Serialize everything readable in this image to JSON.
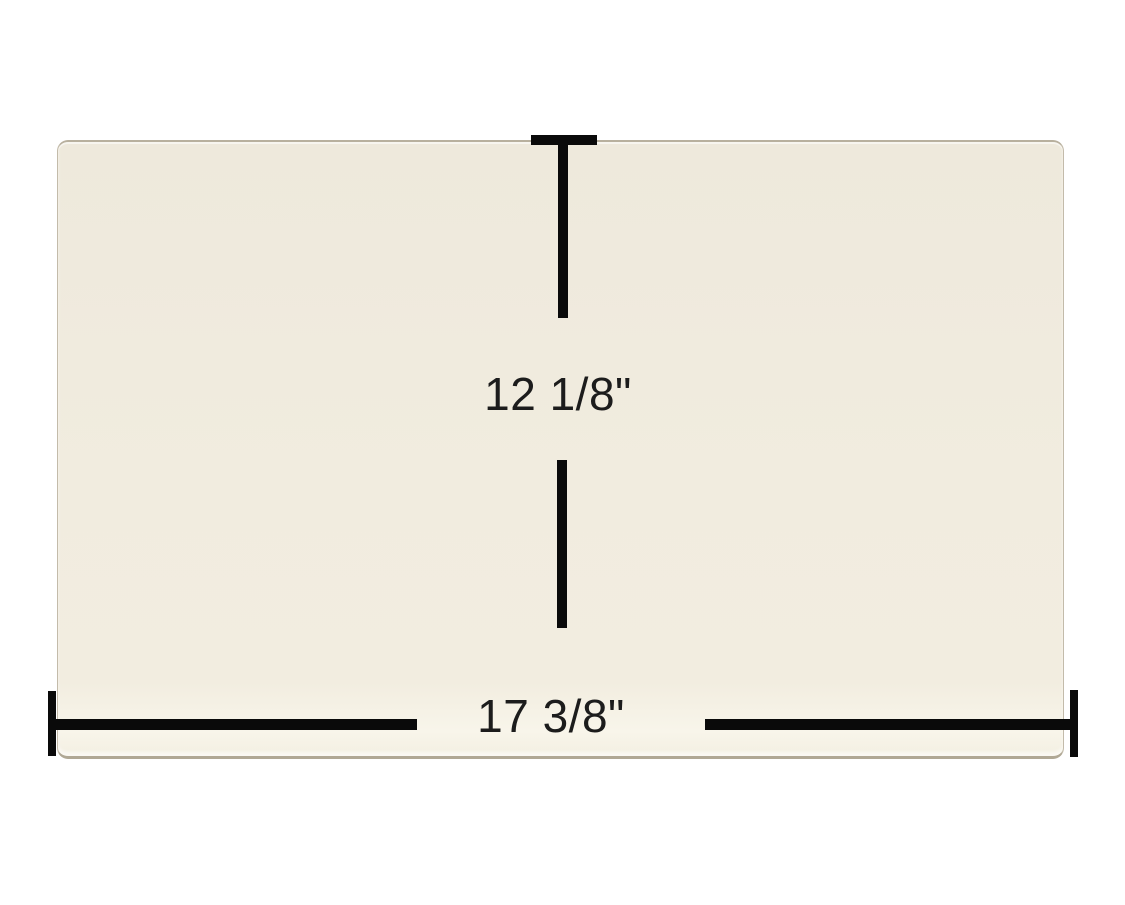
{
  "diagram": {
    "height_label": "12 1/8\"",
    "width_label": "17 3/8\"",
    "colors": {
      "background": "#ffffff",
      "panel_fill": "#f0ebdf",
      "panel_edge": "#b8b09e",
      "dimension_line": "#0a0a0a",
      "label_text": "#1c1c1c"
    }
  }
}
